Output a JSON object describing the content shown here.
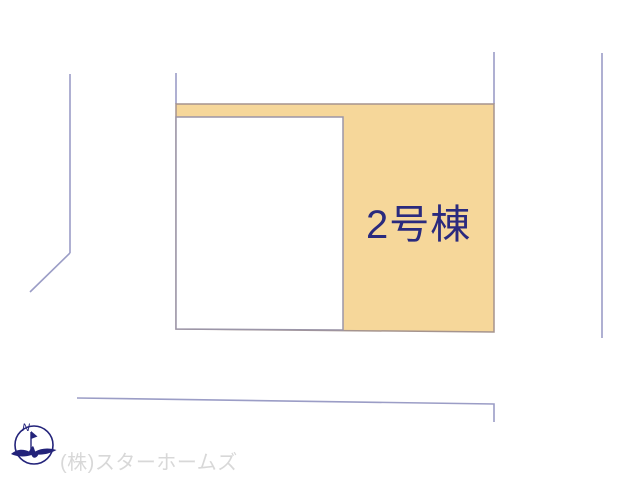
{
  "site_plan": {
    "building_label": "2号棟",
    "building_label_color": "#2a2a7e",
    "parcel_fill_color": "#f6d79a",
    "boundary_line_color": "#9b9dc6",
    "parcel_outline_color": "#a5948e"
  },
  "compass": {
    "north_label": "N",
    "color": "#23237a"
  },
  "footer": {
    "company_name": "(株)スターホームズ",
    "color": "#d8d8d8"
  }
}
